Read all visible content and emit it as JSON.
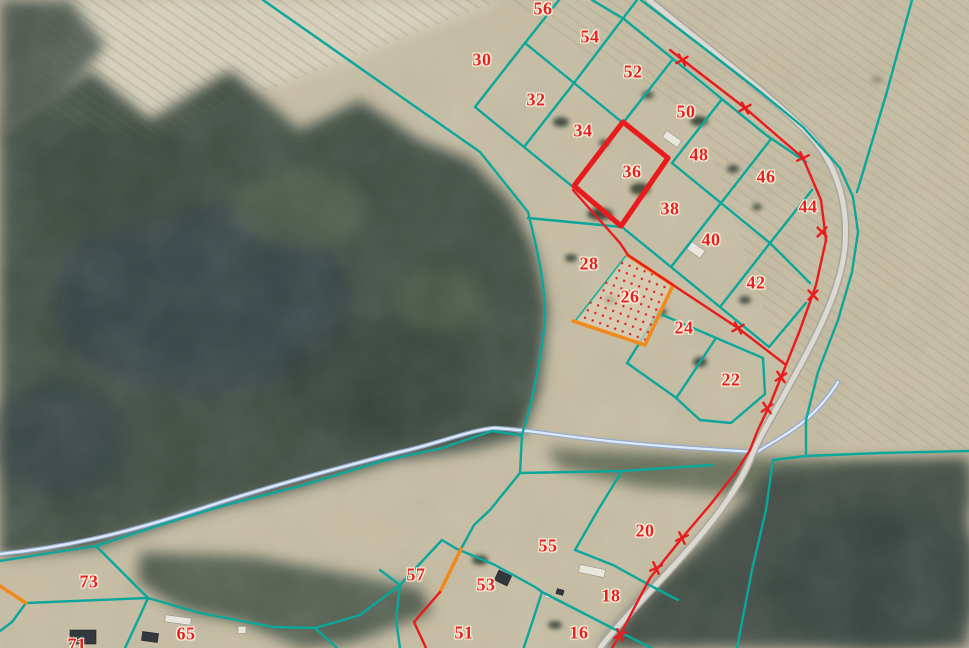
{
  "map": {
    "kind": "cadastral-parcel-overlay-on-aerial-photo",
    "width_px": 969,
    "height_px": 648
  },
  "colors": {
    "teal": "#0aa79a",
    "red_line": "#e81c1c",
    "orange": "#f08a1d",
    "label": "#e62020",
    "stream": "#dfeafc",
    "stream_edge": "#92aacd",
    "road": "#dcd9d2",
    "road_edge": "#a9a69e"
  },
  "highlights": {
    "thick_red_outline_parcel": "36",
    "orange_outline_dotted_fill_parcel": "26"
  },
  "labels": [
    {
      "num": "56",
      "x": 543,
      "y": 9
    },
    {
      "num": "54",
      "x": 590,
      "y": 37
    },
    {
      "num": "30",
      "x": 482,
      "y": 60
    },
    {
      "num": "52",
      "x": 633,
      "y": 72
    },
    {
      "num": "32",
      "x": 536,
      "y": 100
    },
    {
      "num": "50",
      "x": 686,
      "y": 112
    },
    {
      "num": "34",
      "x": 583,
      "y": 131
    },
    {
      "num": "48",
      "x": 699,
      "y": 155
    },
    {
      "num": "36",
      "x": 632,
      "y": 172
    },
    {
      "num": "46",
      "x": 766,
      "y": 177
    },
    {
      "num": "44",
      "x": 808,
      "y": 207
    },
    {
      "num": "38",
      "x": 670,
      "y": 209
    },
    {
      "num": "40",
      "x": 711,
      "y": 240
    },
    {
      "num": "28",
      "x": 589,
      "y": 264
    },
    {
      "num": "42",
      "x": 756,
      "y": 283
    },
    {
      "num": "26",
      "x": 630,
      "y": 297
    },
    {
      "num": "24",
      "x": 684,
      "y": 328
    },
    {
      "num": "22",
      "x": 731,
      "y": 380
    },
    {
      "num": "20",
      "x": 645,
      "y": 531
    },
    {
      "num": "55",
      "x": 548,
      "y": 546
    },
    {
      "num": "57",
      "x": 416,
      "y": 575
    },
    {
      "num": "53",
      "x": 486,
      "y": 585
    },
    {
      "num": "73",
      "x": 89,
      "y": 582
    },
    {
      "num": "18",
      "x": 611,
      "y": 596
    },
    {
      "num": "51",
      "x": 464,
      "y": 633
    },
    {
      "num": "16",
      "x": 579,
      "y": 633
    },
    {
      "num": "65",
      "x": 186,
      "y": 634
    },
    {
      "num": "71",
      "x": 77,
      "y": 645
    }
  ]
}
